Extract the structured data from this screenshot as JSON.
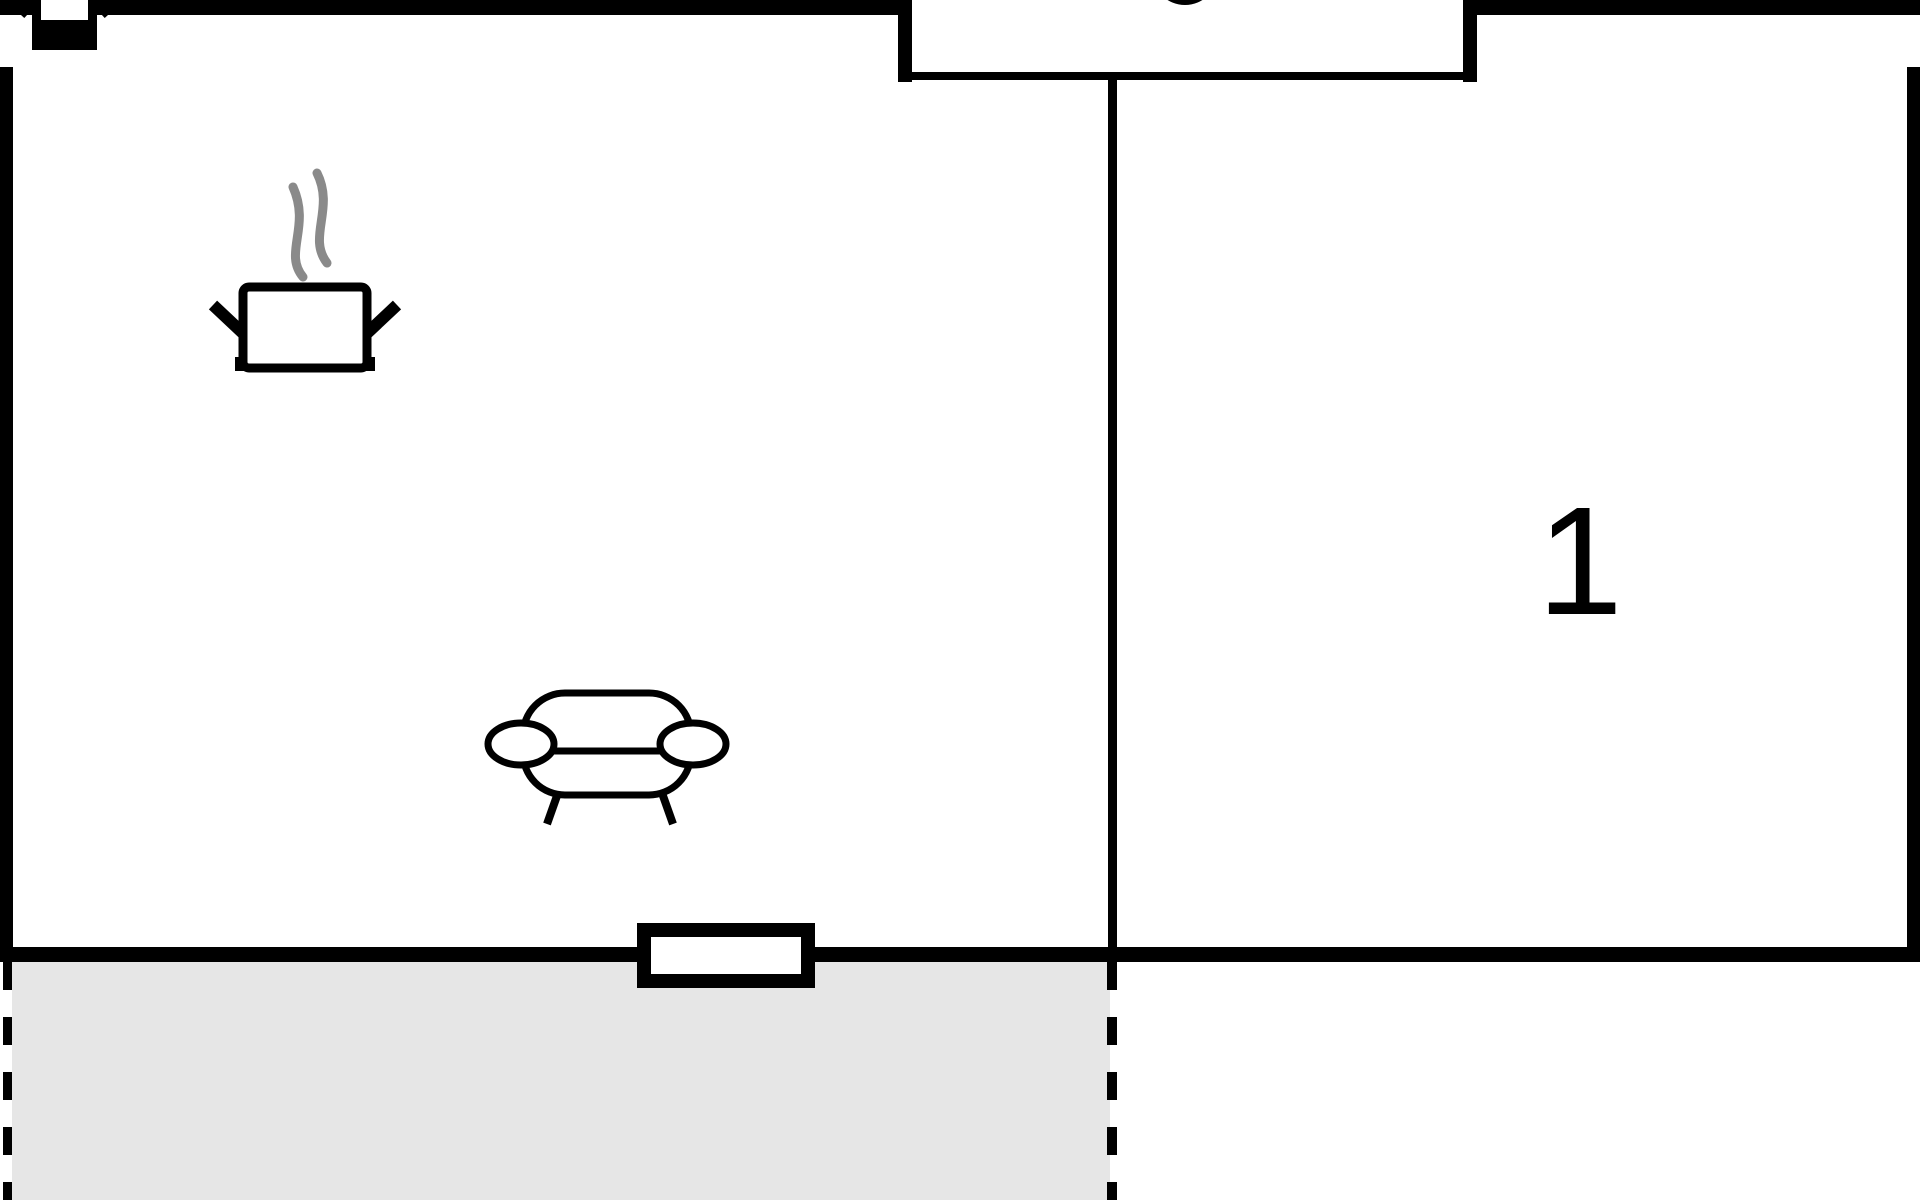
{
  "rooms": {
    "bedroom": {
      "label": "1"
    },
    "living_kitchen": {
      "label": ""
    },
    "terrace": {
      "label": ""
    }
  },
  "colors": {
    "wall": "#000000",
    "background": "#ffffff",
    "terrace_fill": "#e6e6e6",
    "steam": "#8a8a8a"
  },
  "icons": [
    {
      "name": "cooking-pot-icon",
      "meaning": "kitchen area"
    },
    {
      "name": "steam-icon",
      "meaning": "steam above pot"
    },
    {
      "name": "sofa-icon",
      "meaning": "living area seating"
    },
    {
      "name": "pot-bottom-partial-icon",
      "meaning": "icon cut off at top edge"
    },
    {
      "name": "circle-bottom-partial-icon",
      "meaning": "shape cut off at top edge"
    }
  ]
}
